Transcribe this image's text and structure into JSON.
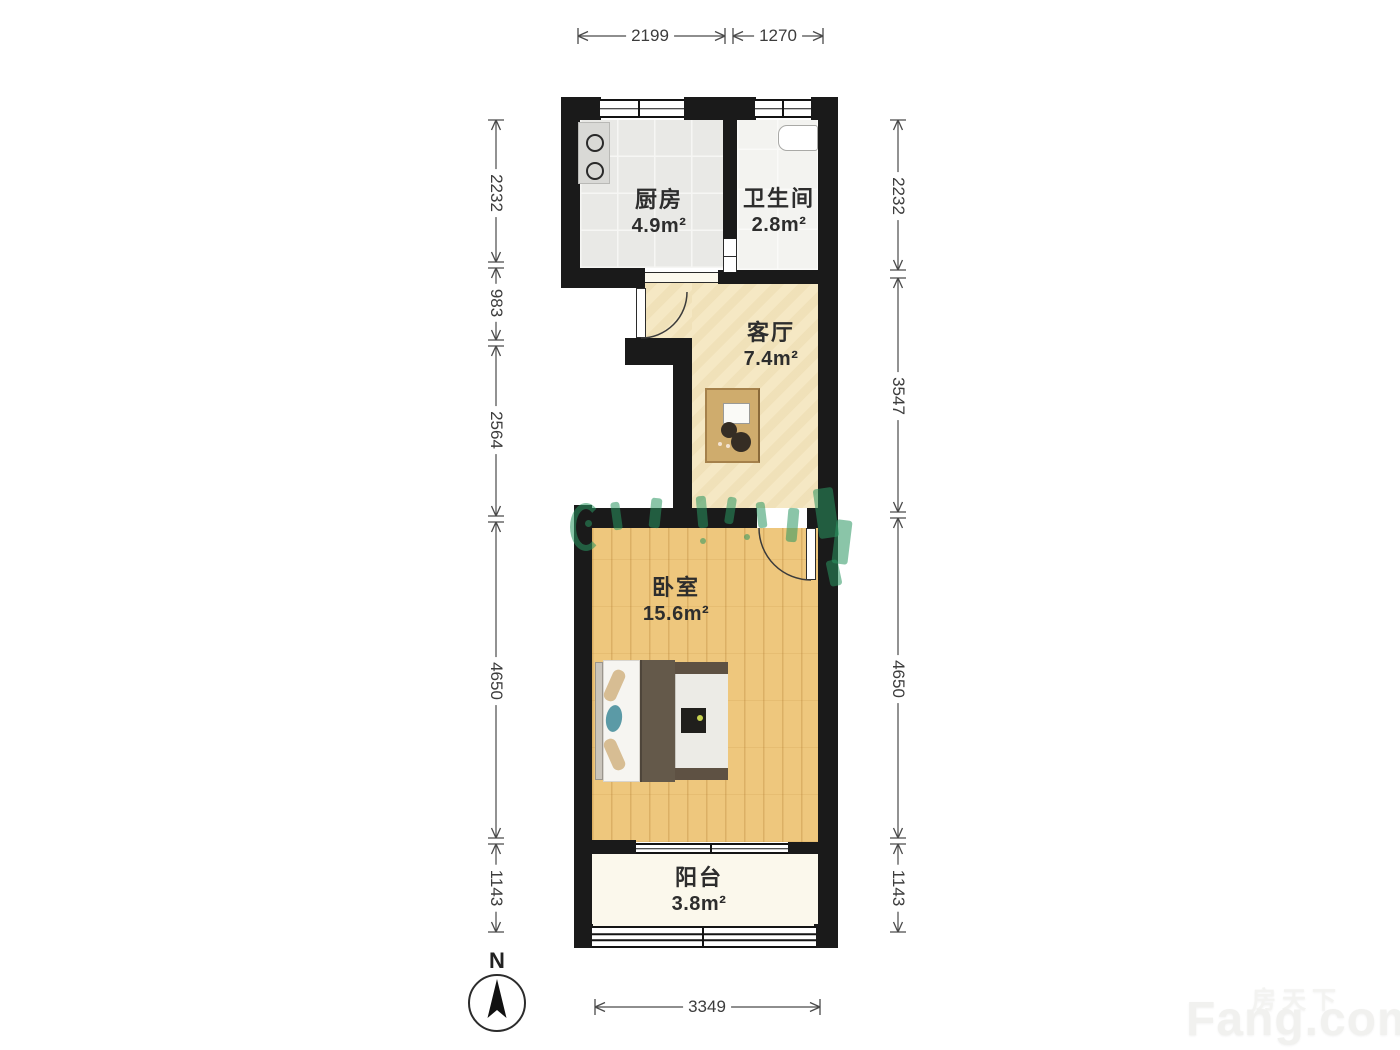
{
  "plan": {
    "rooms": {
      "kitchen": {
        "name": "厨房",
        "area": "4.9m²"
      },
      "bathroom": {
        "name": "卫生间",
        "area": "2.8m²"
      },
      "living": {
        "name": "客厅",
        "area": "7.4m²"
      },
      "bedroom": {
        "name": "卧室",
        "area": "15.6m²"
      },
      "balcony": {
        "name": "阳台",
        "area": "3.8m²"
      }
    },
    "dimensions_mm": {
      "top": [
        "2199",
        "1270"
      ],
      "left": [
        "2232",
        "983",
        "2564",
        "4650",
        "1143"
      ],
      "right": [
        "2232",
        "3547",
        "4650",
        "1143"
      ],
      "bottom": [
        "3349"
      ]
    },
    "compass_label": "N"
  },
  "watermark": {
    "site_cn": "房天下",
    "site_en": "Fang.com"
  },
  "colors": {
    "wall": "#1a1a1a",
    "kitchen_floor": "#e9e9e6",
    "bathroom_floor": "#f3f3f0",
    "living_floor": "#f5e8c4",
    "bedroom_floor": "#eec77d",
    "balcony_floor": "#fbf8ec",
    "watermark_green": "#2a9661",
    "teal_cushion": "#5b9aa6"
  }
}
